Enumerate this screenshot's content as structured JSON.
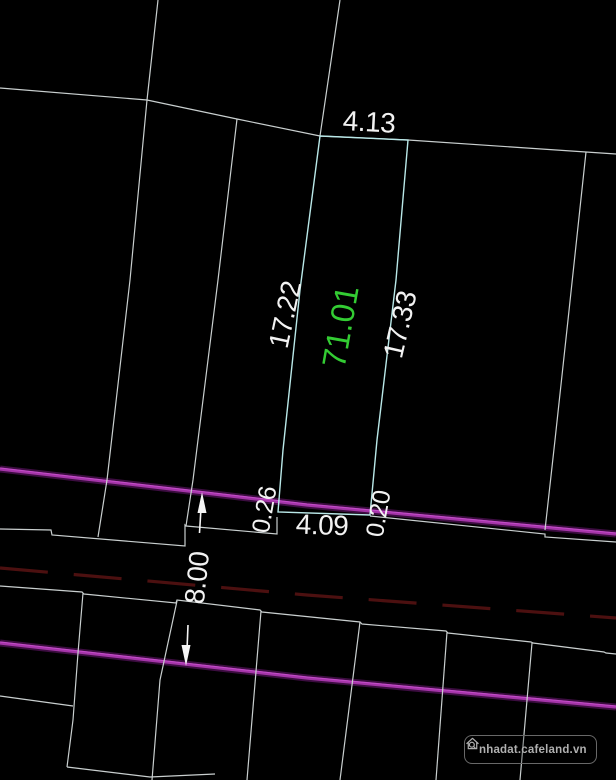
{
  "labels": {
    "back_width": "4.13",
    "left_length": "17.22",
    "area": "71.01",
    "right_length": "17.33",
    "left_offset": "0.26",
    "front_width": "4.09",
    "right_offset": "0.20",
    "road_width": "8.00"
  },
  "watermark": {
    "text": "nhadat.cafeland.vn",
    "icon": "house-search-icon"
  },
  "colors": {
    "background": "#000000",
    "boundary_line": "#c9cfcf",
    "parcel_outline": "#b9e8e8",
    "area_text": "#33cc33",
    "dimension_text": "#f2f2f2",
    "road_line": "#a435a8",
    "road_halo": "#3c0d40",
    "road_centerline": "#4c1010",
    "watermark": "#b0b0b0"
  }
}
